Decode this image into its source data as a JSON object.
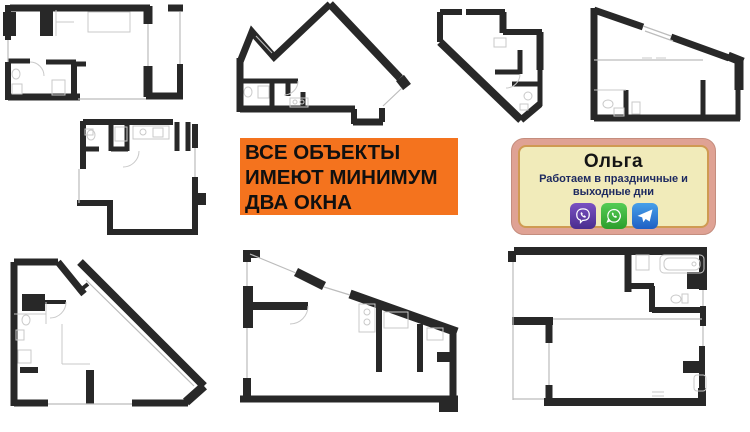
{
  "banner": {
    "lines": [
      "ВСЕ ОБЪЕКТЫ",
      "ИМЕЮТ МИНИМУМ",
      "ДВА ОКНА"
    ],
    "bg_color": "#F4731E",
    "text_color": "#101010"
  },
  "contact_card": {
    "name": "Ольга",
    "subtitle_line1": "Работаем в праздничные и",
    "subtitle_line2": "выходные дни",
    "frame_color": "#DFA294",
    "panel_color": "#F1EBBA",
    "subtitle_color": "#1E2A60",
    "icons": [
      {
        "id": "viber",
        "color": "#5B3A9E"
      },
      {
        "id": "whatsapp",
        "color": "#3FB43F"
      },
      {
        "id": "telegram",
        "color": "#2E6FD0"
      }
    ]
  },
  "floor_plans": {
    "count": 8,
    "wall_color": "#282828",
    "fixture_color": "#C9C9C9",
    "items": [
      {
        "id": "plan-1",
        "position": "top-left"
      },
      {
        "id": "plan-2",
        "position": "middle-left"
      },
      {
        "id": "plan-3",
        "position": "bottom-left"
      },
      {
        "id": "plan-4",
        "position": "top-middle"
      },
      {
        "id": "plan-5",
        "position": "bottom-middle"
      },
      {
        "id": "plan-6",
        "position": "top-center-right"
      },
      {
        "id": "plan-7",
        "position": "top-right"
      },
      {
        "id": "plan-8",
        "position": "bottom-right"
      }
    ]
  }
}
